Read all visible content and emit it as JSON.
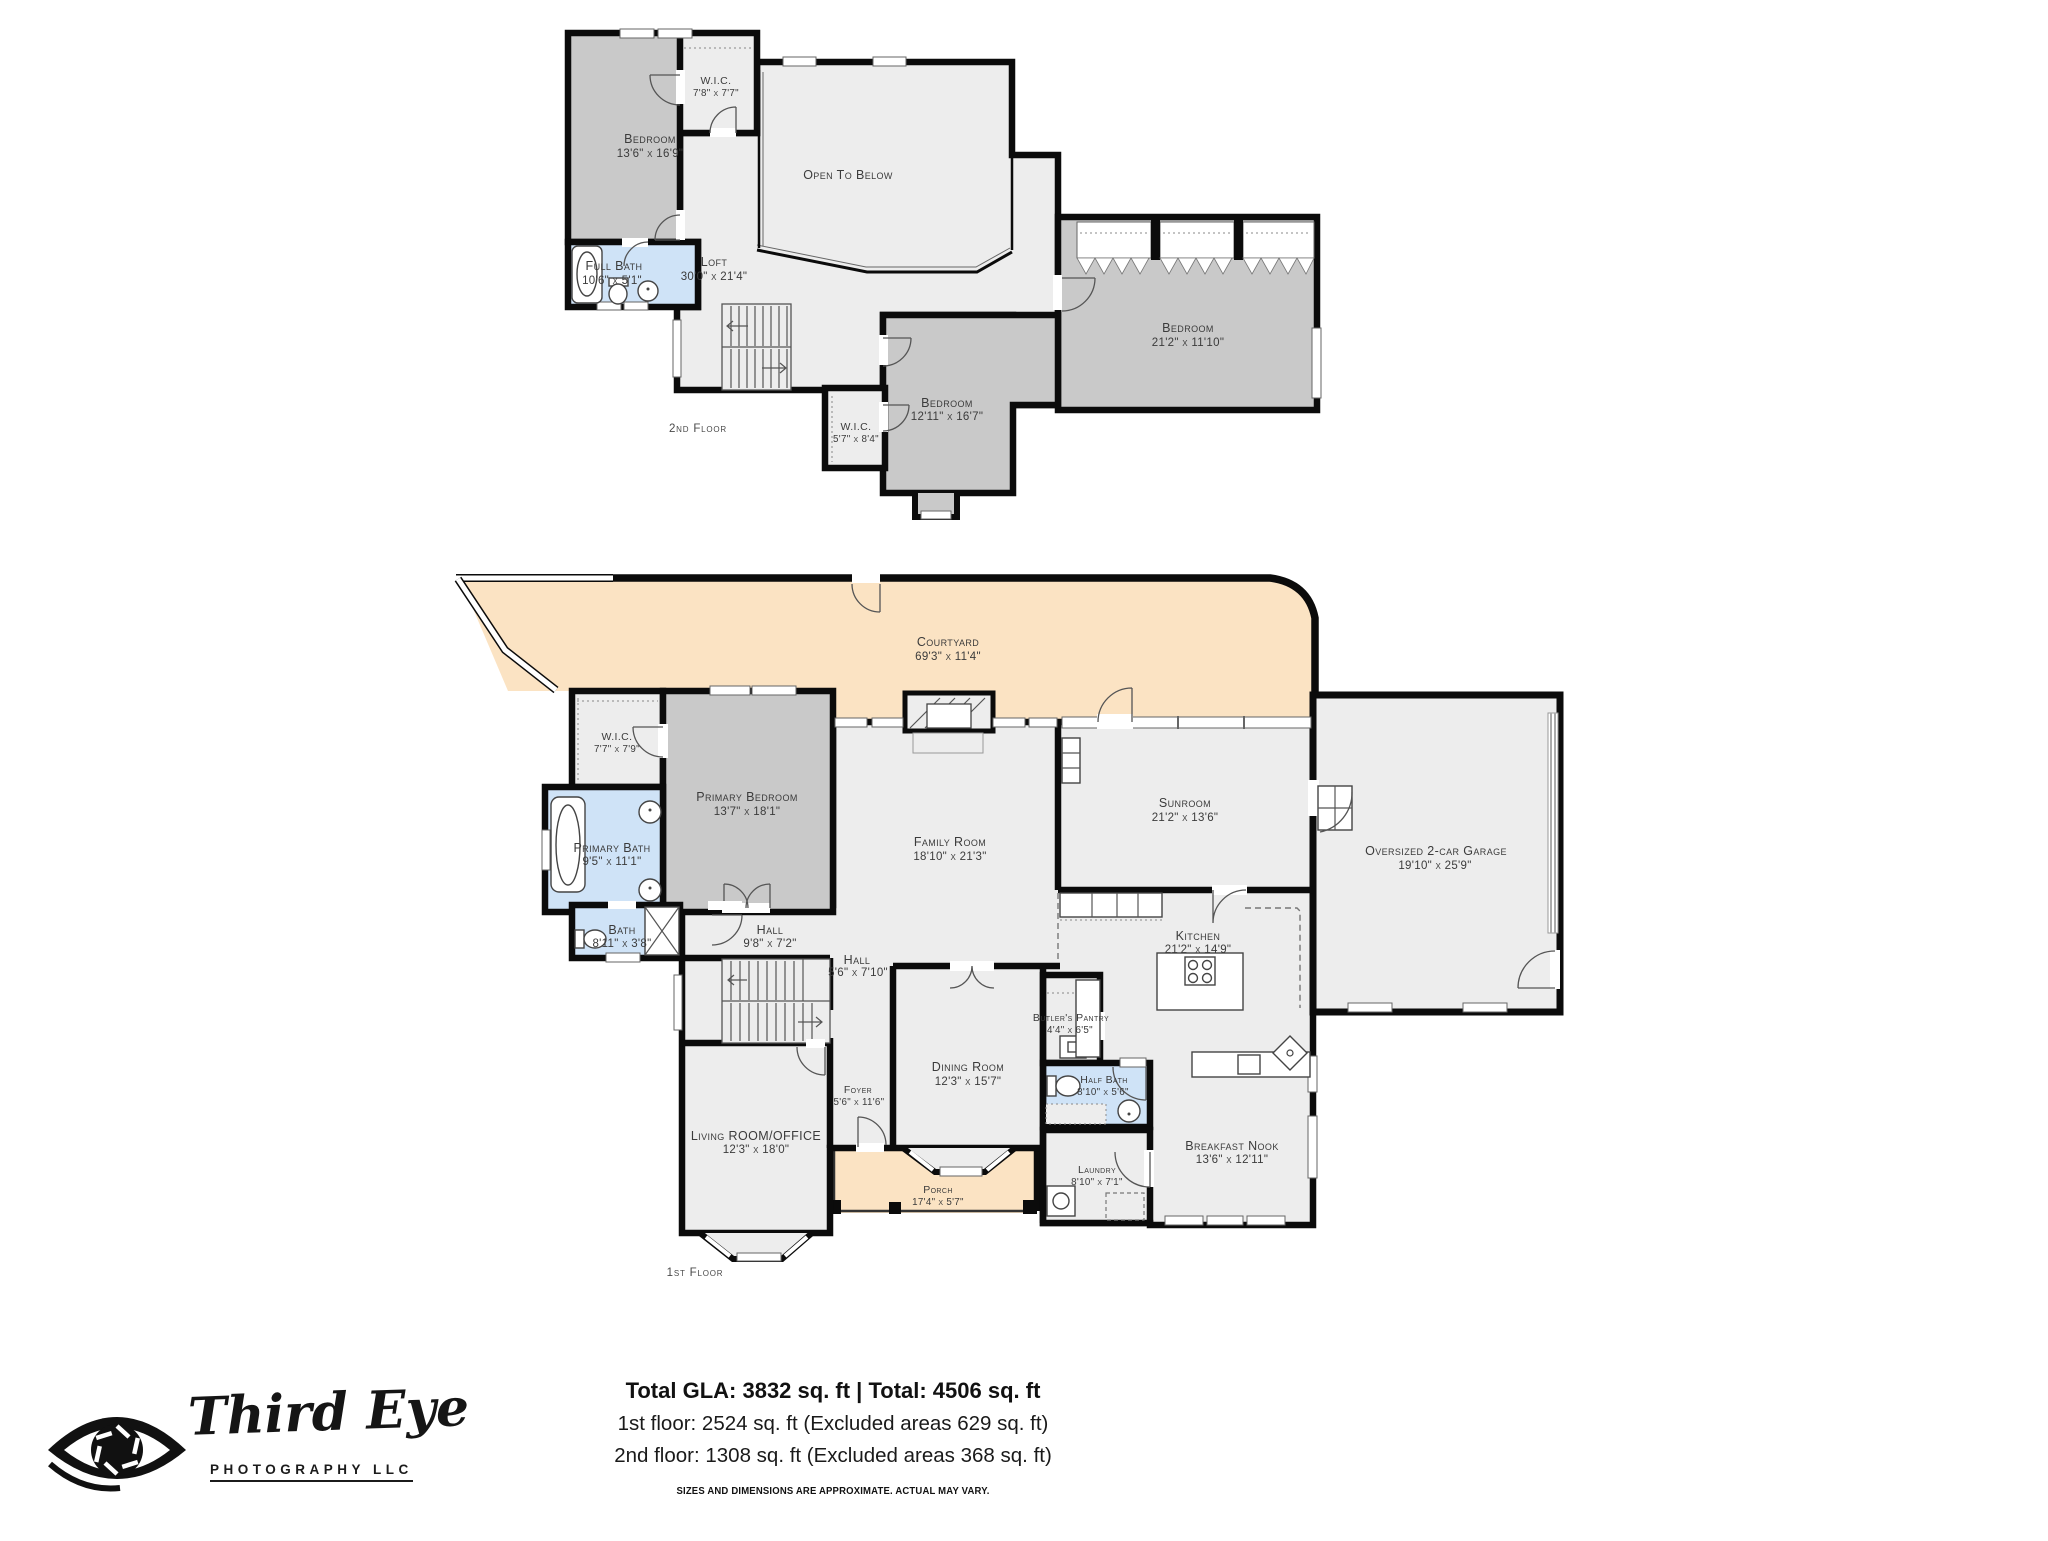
{
  "colors": {
    "wall": "#0b0b0b",
    "room": "#ededed",
    "bedroom": "#c9c9c9",
    "bath": "#cfe3f7",
    "outdoor": "#fbe3c3",
    "label": "#3b3b3b"
  },
  "floor2": {
    "label": "2nd Floor",
    "rooms": {
      "bedroom_tl": {
        "name": "Bedroom",
        "dims": "13'6\" x 16'9\""
      },
      "wic_top": {
        "name": "W.I.C.",
        "dims": "7'8\" x 7'7\""
      },
      "open_to_below": {
        "name": "Open To Below"
      },
      "loft": {
        "name": "Loft",
        "dims": "30'0\" x 21'4\""
      },
      "full_bath": {
        "name": "Full Bath",
        "dims": "10'6\" x 5'1\""
      },
      "bedroom_right": {
        "name": "Bedroom",
        "dims": "21'2\" x 11'10\""
      },
      "bedroom_bottom": {
        "name": "Bedroom",
        "dims": "12'11\" x 16'7\""
      },
      "wic_bottom": {
        "name": "W.I.C.",
        "dims": "5'7\" x 8'4\""
      }
    }
  },
  "floor1": {
    "label": "1st Floor",
    "rooms": {
      "courtyard": {
        "name": "Courtyard",
        "dims": "69'3\" x 11'4\""
      },
      "wic": {
        "name": "W.I.C.",
        "dims": "7'7\" x 7'9\""
      },
      "primary_bedroom": {
        "name": "Primary Bedroom",
        "dims": "13'7\" x 18'1\""
      },
      "primary_bath": {
        "name": "Primary Bath",
        "dims": "9'5\" x 11'1\""
      },
      "bath": {
        "name": "Bath",
        "dims": "8'11\" x 3'8\""
      },
      "hall": {
        "name": "Hall",
        "dims": "9'8\" x 7'2\""
      },
      "hall2": {
        "name": "Hall",
        "dims": "5'6\" x 7'10\""
      },
      "family_room": {
        "name": "Family Room",
        "dims": "18'10\" x 21'3\""
      },
      "sunroom": {
        "name": "Sunroom",
        "dims": "21'2\" x 13'6\""
      },
      "garage": {
        "name": "Oversized 2-car Garage",
        "dims": "19'10\" x 25'9\""
      },
      "kitchen": {
        "name": "Kitchen",
        "dims": "21'2\" x 14'9\""
      },
      "butlers_pantry": {
        "name": "Butler's Pantry",
        "dims": "4'4\" x 6'5\""
      },
      "dining_room": {
        "name": "Dining Room",
        "dims": "12'3\" x 15'7\""
      },
      "half_bath": {
        "name": "Half Bath",
        "dims": "8'10\" x 5'6\""
      },
      "laundry": {
        "name": "Laundry",
        "dims": "8'10\" x 7'1\""
      },
      "breakfast_nook": {
        "name": "Breakfast Nook",
        "dims": "13'6\" x 12'11\""
      },
      "living_room": {
        "name": "Living ROOM/OFFICE",
        "dims": "12'3\" x 18'0\""
      },
      "foyer": {
        "name": "Foyer",
        "dims": "5'6\" x 11'6\""
      },
      "porch": {
        "name": "Porch",
        "dims": "17'4\" x 5'7\""
      }
    }
  },
  "summary": {
    "total": "Total GLA: 3832 sq. ft | Total: 4506 sq. ft",
    "first_floor": "1st floor: 2524 sq. ft (Excluded areas 629 sq. ft)",
    "second_floor": "2nd floor: 1308 sq. ft (Excluded areas 368 sq. ft)",
    "disclaimer": "SIZES AND DIMENSIONS ARE APPROXIMATE. ACTUAL MAY VARY."
  },
  "logo": {
    "name": "Third Eye",
    "tagline": "PHOTOGRAPHY LLC"
  }
}
